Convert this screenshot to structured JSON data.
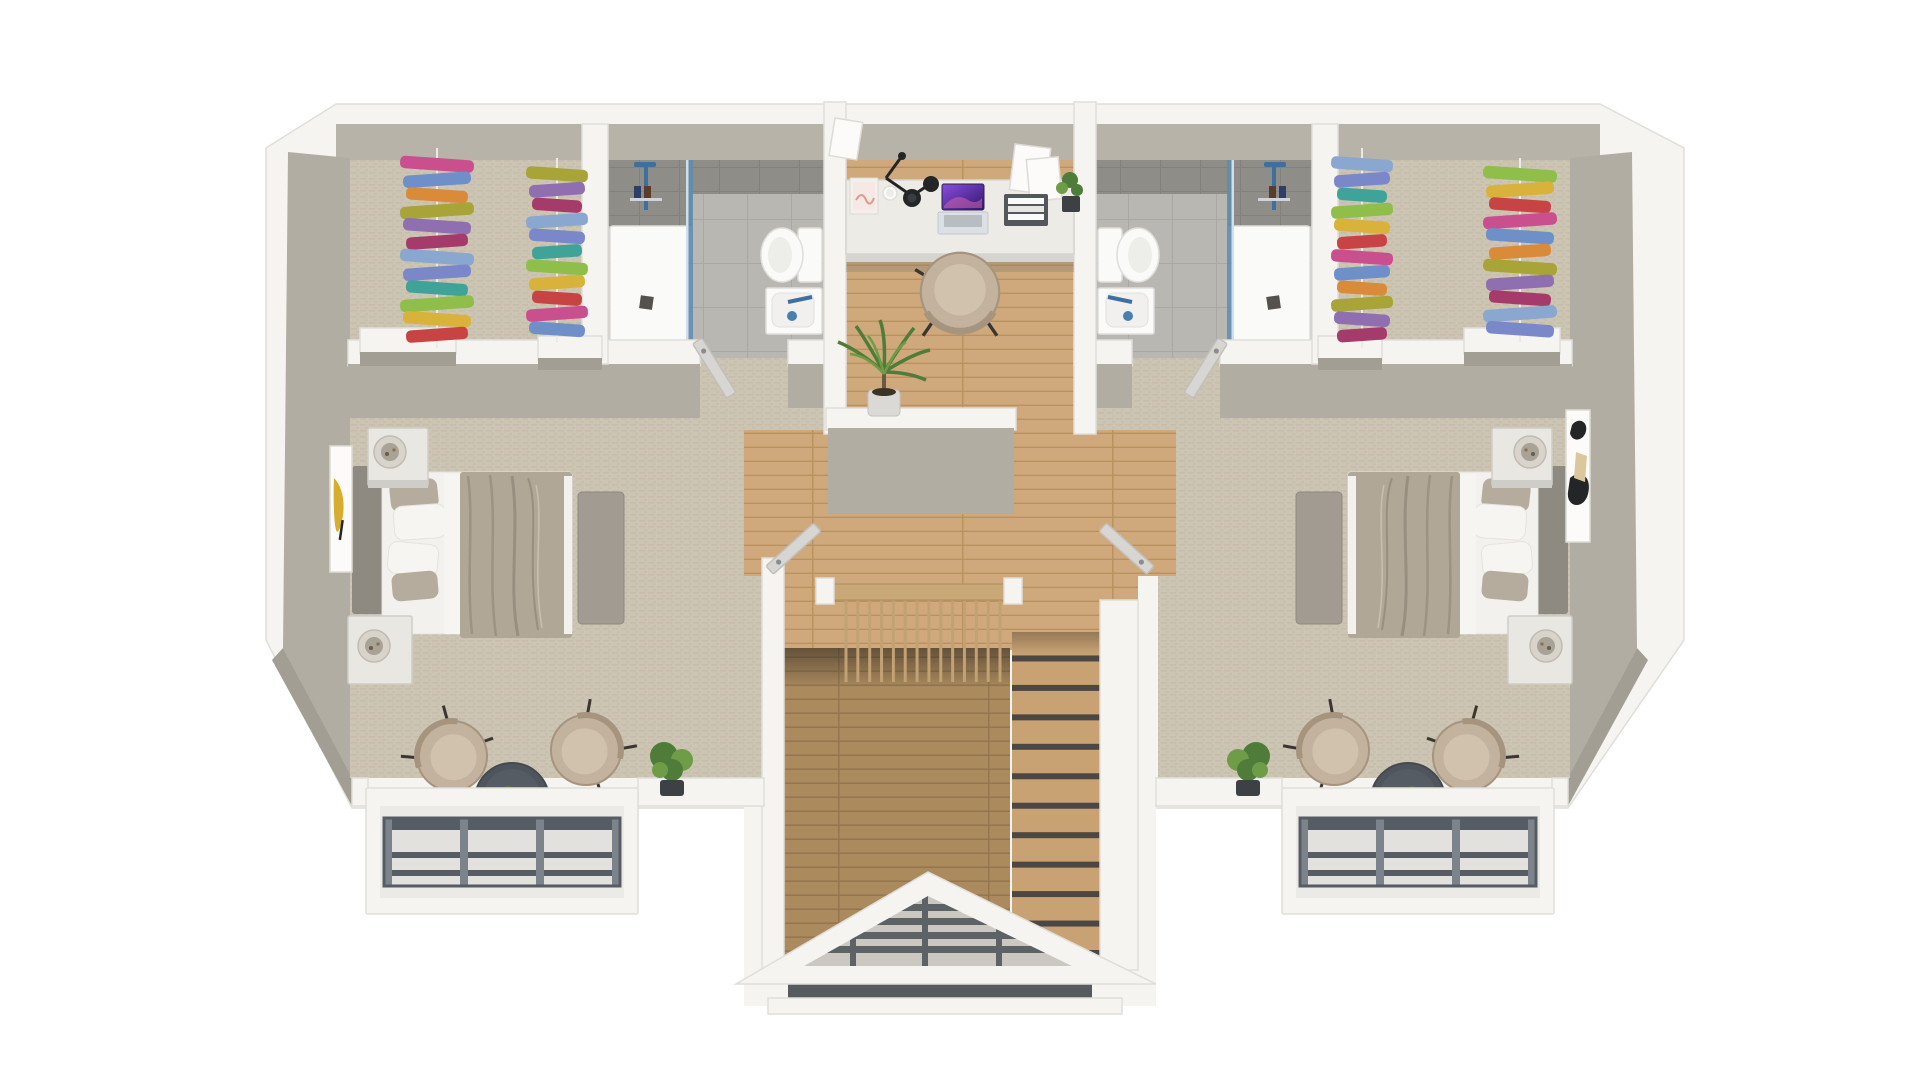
{
  "meta": {
    "type": "3d-floor-plan-render",
    "description": "Isometric top-down 3D render of an upper floor: two mirrored bedroom suites with walk-in closets full of colorful hanging clothes and en-suite bathrooms, a central wall-desk nook with laptop and chair, a staircase hall with wood balustrade, two Juliet balconies with dark railings, and a louvered gable roof over the stair entry",
    "background": "#ffffff"
  },
  "palette": {
    "bg": "#ffffff",
    "slab": "#f5f4f1",
    "slabStroke": "#e0ded9",
    "face": "#b1ada3",
    "faceDark": "#a29e94",
    "faceTop": "#b7b3a9",
    "carpet": "#cdc5b3",
    "carpetLine": "#c1b8a4",
    "wood": "#cfa97c",
    "woodLine": "#b9925f",
    "woodDark": "#ab8a5e",
    "woodDarkLine": "#947750",
    "tread": "#c9a273",
    "treadGap": "#4c4743",
    "spindle": "#c2a173",
    "railWood": "#c9a878",
    "railWoodEdge": "#ad8c5c",
    "tile": "#b9b7b2",
    "tileLine": "#aaa8a3",
    "tileWall": "#8f8d88",
    "tileWallLine": "#83817c",
    "fixture": "#fafaf9",
    "fixtureShade": "#dfdedb",
    "glass": "#cfe0ec",
    "glassEdge": "#5f8cb0",
    "drain": "#55524d",
    "steel": "#3e6f9e",
    "headboard": "#8f8a81",
    "mattress": "#f3f1ed",
    "pillow": "#f7f5f2",
    "pillowTaupe": "#b6ac9d",
    "duvet": "#b1a797",
    "duvetFold": "#998f80",
    "duvetHi": "#c9c0b0",
    "bench": "#a19b92",
    "nightstand": "#e9e7e2",
    "nightstandEdge": "#cfcdc7",
    "lampShade": "#d8d4cb",
    "lampInner": "#a9a296",
    "chair": "#c3b29d",
    "chairEdge": "#a6947f",
    "cushion": "#d0c2ad",
    "dark": "#3a3632",
    "table": "#4e555d",
    "tableHi": "#565c64",
    "green": "#4f7d39",
    "green2": "#6f9c47",
    "pot": "#3e4143",
    "potLight": "#dbd9d5",
    "rail": "#565c63",
    "railHi": "#7d838a",
    "railBg": "#e3e1dd",
    "louver": "#5d6266",
    "louverGap": "#cbc8c2",
    "eaveBand": "#575b5f",
    "desk": "#edebe6",
    "deskEdge": "#d6d4ce",
    "underDesk": "#7a766f",
    "lampBlack": "#232527",
    "laptopBase": "#dce0e4",
    "keys": "#9aa0a6",
    "book": "#f2f0ed",
    "bookArt": "#dd9b8d",
    "artYellow": "#d6ad2f",
    "artDark": "#242526",
    "artBeige": "#dcc79d",
    "canvas": "#fcfbf9",
    "canvasEdge": "#dddbd5",
    "laptopA": "#8a4de0",
    "laptopB": "#31176b",
    "laptopPink": "#d264ab"
  },
  "rooms": {
    "left_suite": {
      "name": "bedroom-left",
      "furniture": [
        "double-bed",
        "bench",
        "nightstand",
        "nightstand",
        "drum-lamp",
        "drum-lamp",
        "wall-art-yellow",
        "armchair",
        "armchair",
        "round-side-table",
        "mini-plant",
        "potted-shrub",
        "juliet-balcony"
      ],
      "closet": {
        "name": "walk-in-closet-left",
        "racks": 2,
        "shelves": 2
      },
      "bathroom": {
        "name": "bathroom-left",
        "fixtures": [
          "walk-in-shower",
          "glass-screen",
          "toilet",
          "washbasin",
          "door"
        ]
      }
    },
    "right_suite": {
      "name": "bedroom-right",
      "furniture": [
        "double-bed",
        "bench",
        "nightstand",
        "nightstand",
        "drum-lamp",
        "drum-lamp",
        "wall-art-abstract",
        "armchair",
        "armchair",
        "round-side-table",
        "mini-plant",
        "potted-shrub",
        "juliet-balcony"
      ],
      "closet": {
        "name": "walk-in-closet-right",
        "racks": 2,
        "shelves": 2
      },
      "bathroom": {
        "name": "bathroom-right",
        "fixtures": [
          "walk-in-shower",
          "glass-screen",
          "toilet",
          "washbasin",
          "door"
        ]
      }
    },
    "hall": {
      "name": "landing-hall",
      "furniture": [
        "wall-desk",
        "laptop",
        "desk-chair",
        "wall-lamp",
        "standing-book",
        "mug",
        "leaning-frames",
        "letter-tray",
        "desk-plant",
        "potted-palm",
        "half-wall",
        "staircase",
        "balustrade"
      ]
    },
    "exterior": {
      "gable": "louvered-gable-roof",
      "balconies": 2
    }
  },
  "decor": {
    "clothes_colors": [
      "#c94f8e",
      "#a43b6b",
      "#d9b23c",
      "#a8a437",
      "#3fa39a",
      "#6f8fc9",
      "#8aa7cf",
      "#c84444",
      "#8f6fb0",
      "#8fbf4a",
      "#d98b3a",
      "#7a88c9"
    ],
    "closet_racks": [
      {
        "x": 437,
        "y": 158,
        "n": 12,
        "dy": 15.5,
        "w": 74,
        "h": 12.5
      },
      {
        "x": 557,
        "y": 168,
        "n": 11,
        "dy": 15.5,
        "w": 62,
        "h": 12.5
      },
      {
        "x": 1362,
        "y": 158,
        "n": 12,
        "dy": 15.5,
        "w": 62,
        "h": 12.5
      },
      {
        "x": 1520,
        "y": 168,
        "n": 11,
        "dy": 15.5,
        "w": 74,
        "h": 12.5
      }
    ],
    "stairs": {
      "x": 1012,
      "w": 88,
      "y0": 632,
      "y1": 956,
      "n": 11
    },
    "balustrade": {
      "x0": 846,
      "x1": 1000,
      "y": 600,
      "h": 82,
      "n": 14
    },
    "balcony_grids": [
      {
        "x": 384,
        "y": 818,
        "w": 236,
        "h": 68
      },
      {
        "x": 1300,
        "y": 818,
        "w": 236,
        "h": 68
      }
    ]
  }
}
